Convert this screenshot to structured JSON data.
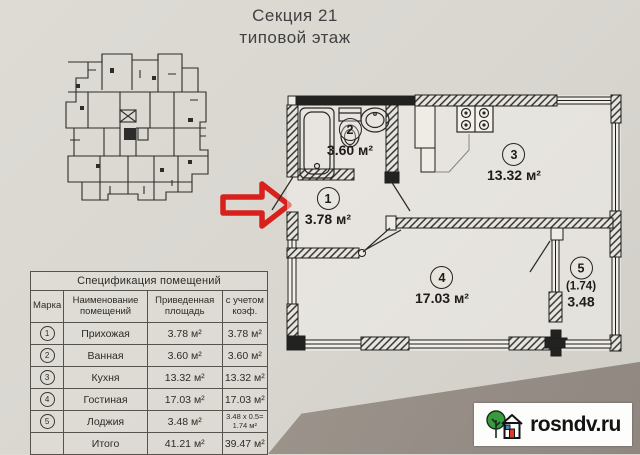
{
  "header": {
    "title_line1": "Секция 21",
    "title_line2": "типовой этаж"
  },
  "plan": {
    "rooms": [
      {
        "mark": "1",
        "area": "3.78 м²"
      },
      {
        "mark": "2",
        "area": "3.60 м²"
      },
      {
        "mark": "3",
        "area": "13.32 м²"
      },
      {
        "mark": "4",
        "area": "17.03 м²"
      },
      {
        "mark": "5",
        "note": "(1.74)",
        "area": "3.48"
      }
    ]
  },
  "spec_table": {
    "title": "Спецификация помещений",
    "columns": [
      "Марка",
      "Наименование помещений",
      "Приведенная площадь",
      "с учетом коэф."
    ],
    "rows": [
      {
        "mark": "1",
        "name": "Прихожая",
        "area": "3.78 м²",
        "coef": "3.78 м²"
      },
      {
        "mark": "2",
        "name": "Ванная",
        "area": "3.60 м²",
        "coef": "3.60 м²"
      },
      {
        "mark": "3",
        "name": "Кухня",
        "area": "13.32 м²",
        "coef": "13.32 м²"
      },
      {
        "mark": "4",
        "name": "Гостиная",
        "area": "17.03 м²",
        "coef": "17.03 м²"
      },
      {
        "mark": "5",
        "name": "Лоджия",
        "area": "3.48 м²",
        "coef_line1": "3.48 x 0.5=",
        "coef_line2": "1.74 м²"
      },
      {
        "mark": "",
        "name": "Итого",
        "area": "41.21 м²",
        "coef": "39.47 м²"
      }
    ]
  },
  "watermark": {
    "site": "rosndv.ru"
  },
  "colors": {
    "arrow_red": "#d8201c",
    "paper": "#d9d6d0",
    "wall_ink": "#1f1d1b",
    "logo_green": "#3a9a3f",
    "logo_red": "#d93a2b",
    "logo_blue": "#4a7fc1",
    "dark_surface": "#948c84"
  }
}
